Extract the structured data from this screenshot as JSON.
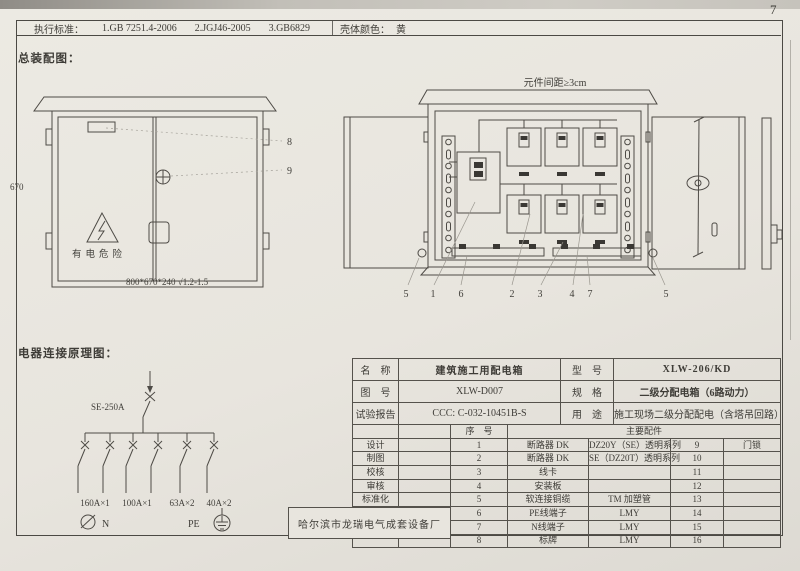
{
  "page_number": "7",
  "header": {
    "standards_label": "执行标准：",
    "standard_1": "1.GB 7251.4-2006",
    "standard_2": "2.JGJ46-2005",
    "standard_3": "3.GB6829",
    "shell_color_label": "壳体颜色：",
    "shell_color_value": "黄"
  },
  "assembly": {
    "section_title": "总装配图：",
    "front_view": {
      "height_dim": "670",
      "warning_text": "有电危险",
      "dimensions_note": "800*670*240 √1.2-1.5",
      "callout_8": "8",
      "callout_9": "9"
    },
    "open_view": {
      "spacing_note": "元件间距≥3cm",
      "callouts": [
        "5",
        "1",
        "6",
        "2",
        "3",
        "4",
        "7",
        "5"
      ]
    }
  },
  "schematic": {
    "section_title": "电器连接原理图：",
    "main_breaker_label": "SE-250A",
    "branch_labels": [
      "160A×1",
      "100A×1",
      "63A×2",
      "40A×2"
    ],
    "neutral_label": "N",
    "pe_label": "PE"
  },
  "info_table": {
    "rows": [
      {
        "label": "名　称",
        "value": "建筑施工用配电箱",
        "label2": "型　号",
        "value2": "XLW-206/KD"
      },
      {
        "label": "图　号",
        "value": "XLW-D007",
        "label2": "规　格",
        "value2": "二级分配电箱（6路动力）"
      },
      {
        "label": "试验报告",
        "value": "CCC: C-032-10451B-S",
        "label2": "用　途",
        "value2": "施工现场二级分配配电（含塔吊回路）"
      }
    ]
  },
  "parts_table": {
    "serial_header": "序　号",
    "accessories_header": "主要配件",
    "sign_labels": [
      "设计",
      "制图",
      "校核",
      "审核",
      "标准化",
      "日期"
    ],
    "rows": [
      {
        "no": "1",
        "name": "断路器 DK",
        "spec": "DZ20Y（SE）透明系列",
        "no2": "9",
        "name2": "门锁"
      },
      {
        "no": "2",
        "name": "断路器 DK",
        "spec": "SE（DZ20T）透明系列",
        "no2": "10",
        "name2": ""
      },
      {
        "no": "3",
        "name": "线卡",
        "spec": "",
        "no2": "11",
        "name2": ""
      },
      {
        "no": "4",
        "name": "安装板",
        "spec": "",
        "no2": "12",
        "name2": ""
      },
      {
        "no": "5",
        "name": "软连接铜缆",
        "spec": "TM 加塑管",
        "no2": "13",
        "name2": ""
      },
      {
        "no": "6",
        "name": "PE线端子",
        "spec": "LMY",
        "no2": "14",
        "name2": ""
      },
      {
        "no": "7",
        "name": "N线端子",
        "spec": "LMY",
        "no2": "15",
        "name2": ""
      },
      {
        "no": "8",
        "name": "标牌",
        "spec": "LMY",
        "no2": "16",
        "name2": ""
      }
    ],
    "manufacturer": "哈尔滨市龙瑞电气成套设备厂"
  }
}
